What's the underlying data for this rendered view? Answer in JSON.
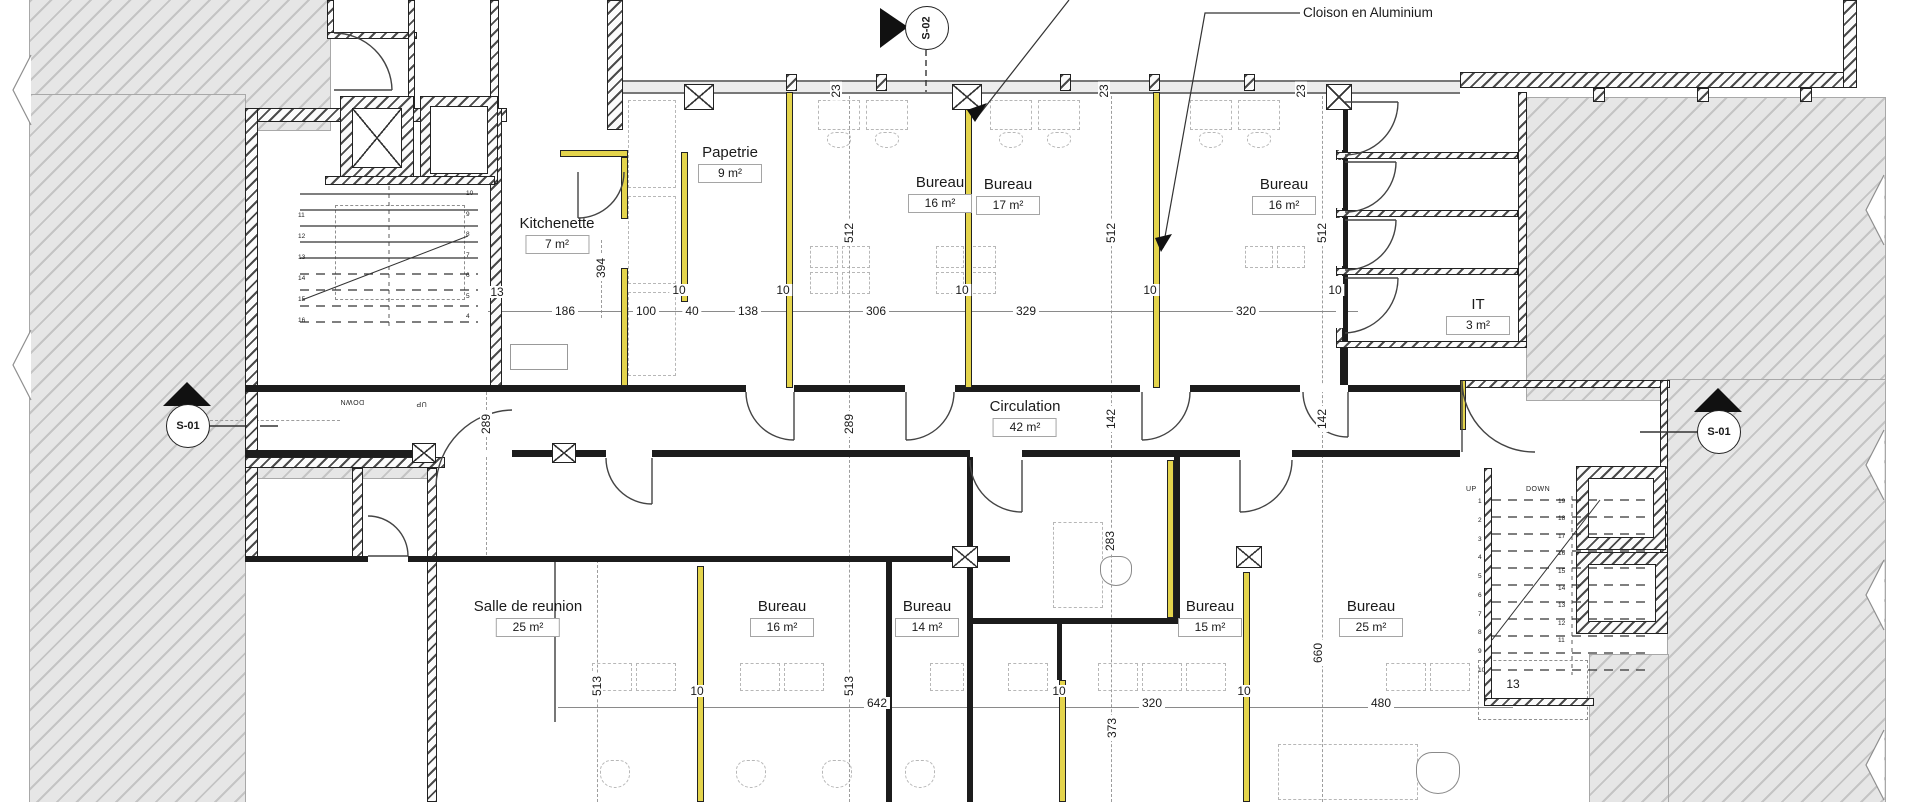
{
  "annotation": {
    "cloison": "Cloison en Aluminium"
  },
  "markers": {
    "top": "S-02",
    "left": "S-01",
    "right": "S-01"
  },
  "rooms": [
    {
      "name": "Papetrie",
      "area": "9 m²"
    },
    {
      "name": "Kitchenette",
      "area": "7 m²"
    },
    {
      "name": "Bureau",
      "area": "16 m²"
    },
    {
      "name": "Bureau",
      "area": "17 m²"
    },
    {
      "name": "Bureau",
      "area": "16 m²"
    },
    {
      "name": "IT",
      "area": "3 m²"
    },
    {
      "name": "Circulation",
      "area": "42 m²"
    },
    {
      "name": "Salle de reunion",
      "area": "25 m²"
    },
    {
      "name": "Bureau",
      "area": "16 m²"
    },
    {
      "name": "Bureau",
      "area": "14 m²"
    },
    {
      "name": "Bureau",
      "area": "15 m²"
    },
    {
      "name": "Bureau",
      "area": "25 m²"
    }
  ],
  "dims": [
    {
      "v": "13"
    },
    {
      "v": "186"
    },
    {
      "v": "10"
    },
    {
      "v": "100"
    },
    {
      "v": "40"
    },
    {
      "v": "138"
    },
    {
      "v": "10"
    },
    {
      "v": "306"
    },
    {
      "v": "10"
    },
    {
      "v": "329"
    },
    {
      "v": "10"
    },
    {
      "v": "320"
    },
    {
      "v": "10"
    },
    {
      "v": "394"
    },
    {
      "v": "512"
    },
    {
      "v": "512"
    },
    {
      "v": "512"
    },
    {
      "v": "23"
    },
    {
      "v": "23"
    },
    {
      "v": "23"
    },
    {
      "v": "289"
    },
    {
      "v": "289"
    },
    {
      "v": "142"
    },
    {
      "v": "142"
    },
    {
      "v": "283"
    },
    {
      "v": "513"
    },
    {
      "v": "513"
    },
    {
      "v": "660"
    },
    {
      "v": "373"
    },
    {
      "v": "642"
    },
    {
      "v": "10"
    },
    {
      "v": "10"
    },
    {
      "v": "320"
    },
    {
      "v": "10"
    },
    {
      "v": "480"
    },
    {
      "v": "13"
    }
  ],
  "stairs": {
    "left": {
      "up": "UP",
      "down": "DOWN",
      "col_a": [
        "11",
        "12",
        "13",
        "14",
        "15",
        "16"
      ],
      "col_b": [
        "10",
        "9",
        "8",
        "7",
        "6",
        "5",
        "4"
      ]
    },
    "right": {
      "up": "UP",
      "down": "DOWN",
      "col_a": [
        "1",
        "2",
        "3",
        "4",
        "5",
        "6",
        "7",
        "8",
        "9",
        "10"
      ],
      "col_b": [
        "19",
        "18",
        "17",
        "16",
        "15",
        "14",
        "13",
        "12",
        "11"
      ]
    }
  }
}
